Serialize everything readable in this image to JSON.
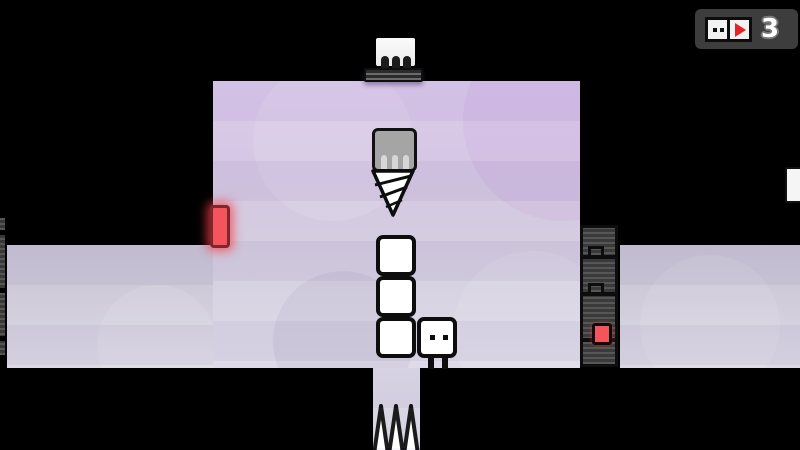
{
  "screen": {
    "type": "puzzle-platformer-level"
  },
  "hud": {
    "box_count": "3",
    "face_icon": "box-character-face",
    "play_icon": "play-triangle",
    "panel_color": "#3d3d3d",
    "play_color": "#e0242a"
  },
  "level": {
    "objects": {
      "dispenser": "box dispenser on ceiling",
      "drill": "drill hazard descending",
      "door": "red glowing door on left wall",
      "box_stack_count": 3,
      "character": "white box character with two eyes",
      "spikes": "upward spikes in floor pit",
      "crash_blocks": "striped interlocking block column",
      "switch": "red square switch"
    },
    "colors": {
      "background": "#000000",
      "main_area_top": "#d9c7ea",
      "main_area_bottom": "#dcd8e6",
      "side_area_top": "#c5c1d2",
      "side_area_bottom": "#dad7e3",
      "accent_red": "#f4545c",
      "block_gray": "#3a3a3a",
      "drill_gray": "#a5a5a5"
    }
  }
}
